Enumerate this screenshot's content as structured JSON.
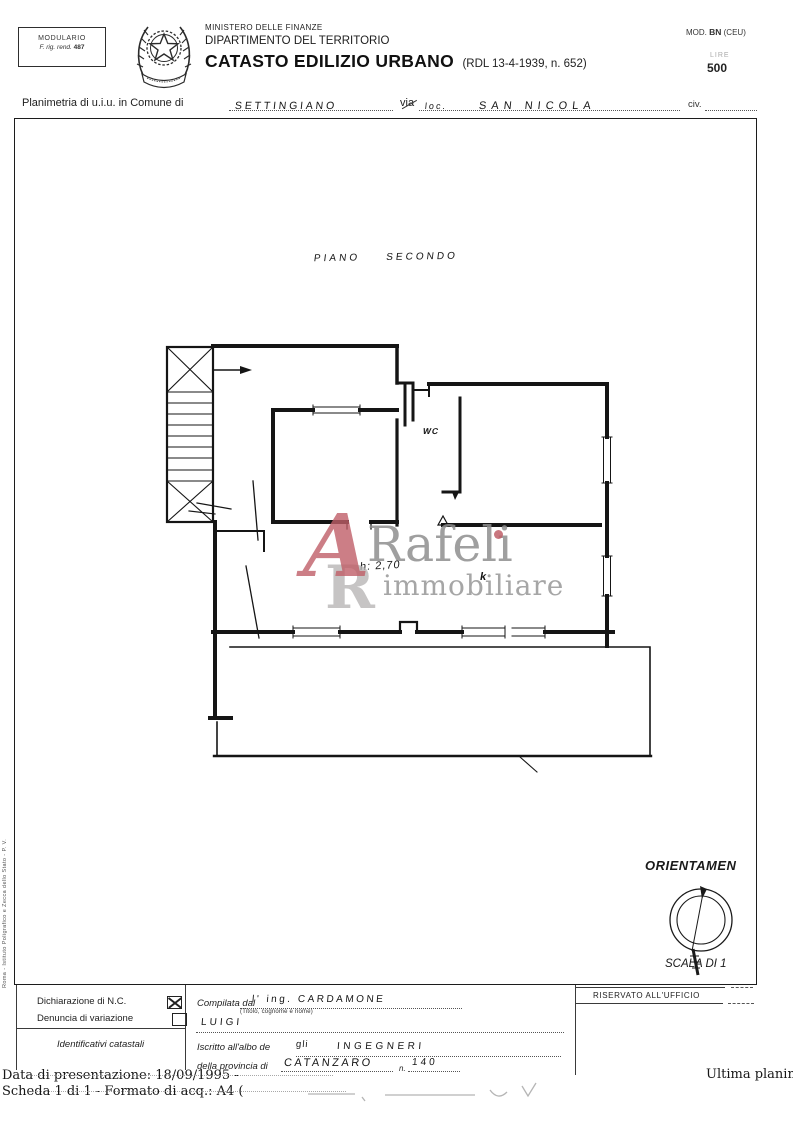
{
  "header": {
    "modulario_title": "MODULARIO",
    "modulario_ref_prefix": "F. rig. rend.",
    "modulario_ref_num": "487",
    "ministero": "MINISTERO DELLE FINANZE",
    "dipartimento": "DIPARTIMENTO DEL TERRITORIO",
    "title": "CATASTO EDILIZIO URBANO",
    "title_ref": "(RDL 13-4-1939, n. 652)",
    "mod_prefix": "MOD.",
    "mod_code": "BN",
    "mod_suffix": "(CEU)",
    "stamp_currency": "LIRE",
    "stamp_value": "500"
  },
  "subject": {
    "prefix": "Planimetria di u.i.u. in Comune di",
    "comune": "SETTINGIANO",
    "via_label": "via",
    "loc_note": "loc.",
    "street": "SAN NICOLA",
    "civ_label": "civ."
  },
  "plan": {
    "floor_word1": "PIANO",
    "floor_word2": "SECONDO",
    "wc_label": "WC",
    "height_note": "h: 2,70",
    "k_mark": "k"
  },
  "watermark": {
    "monogram_a": "A",
    "monogram_r": "R",
    "brand": "Rafeli",
    "subtitle": "immobiliare",
    "accent_color": "#c05f68",
    "gray_color": "#8f8f8f"
  },
  "orientation": {
    "title": "ORIENTAMEN",
    "scale_label": "SCALA DI 1"
  },
  "form": {
    "reserved_title": "RISERVATO ALL'UFFICIO",
    "declaration_label": "Dichiarazione di N.C.",
    "declaration_checked": true,
    "variation_label": "Denuncia di variazione",
    "variation_checked": false,
    "identifiers_label": "Identificativi catastali",
    "compiled_label": "Compilata dal",
    "compiled_value": "l' ing.  CARDAMONE",
    "compiled_hint": "(Titolo, cognome e nome)",
    "name_value": "LUIGI",
    "register_label": "Iscritto all'albo de",
    "register_hand": "gli",
    "register_value": "INGEGNERI",
    "province_label": "della provincia di",
    "province_value": "CATANZARO",
    "number_label": "n.",
    "number_value": "140"
  },
  "footer": {
    "date_line": "Data di presentazione: 18/09/1995 -",
    "sheet_line": "Scheda 1 di 1 - Formato di acq.: A4 (",
    "right_note": "Ultima planim"
  },
  "margin_note": "Roma - Istituto Poligrafico e Zecca dello Stato - P. V."
}
